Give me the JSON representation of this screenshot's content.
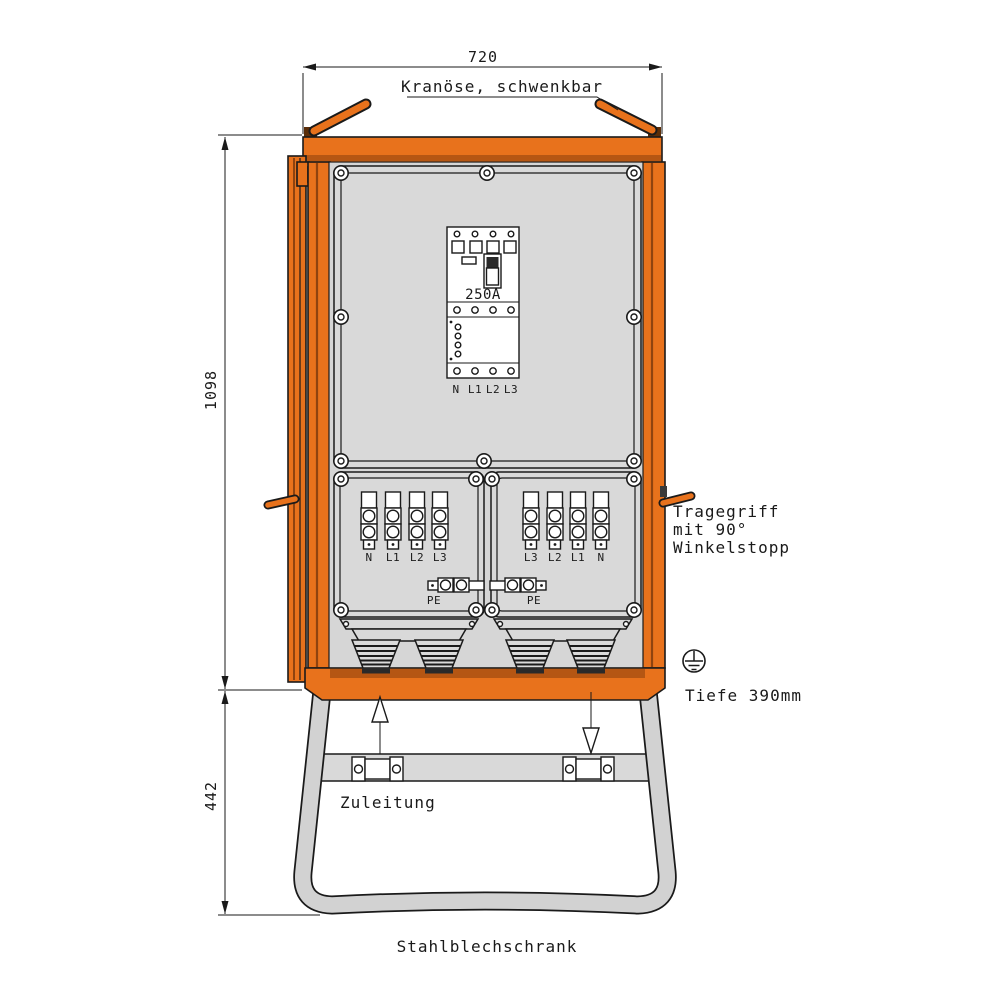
{
  "title": "Stahlblechschrank",
  "dims": {
    "width": "720",
    "body_height": "1098",
    "stand_height": "442"
  },
  "labels": {
    "crane": "Kranöse, schwenkbar",
    "carry1": "Tragegriff",
    "carry2": "mit 90°",
    "carry3": "Winkelstopp",
    "depth": "Tiefe 390mm",
    "supply": "Zuleitung"
  },
  "breaker": {
    "rating": "250A",
    "terminals": [
      "N",
      "L1",
      "L2",
      "L3"
    ]
  },
  "panel_left": {
    "terminals": [
      "N",
      "L1",
      "L2",
      "L3"
    ],
    "pe": "PE"
  },
  "panel_right": {
    "terminals": [
      "L3",
      "L2",
      "L1",
      "N"
    ],
    "pe": "PE"
  },
  "colors": {
    "cabinet_orange": "#E8721C",
    "edge_dark_orange": "#8F430F",
    "inner_lip_orange": "#B55613",
    "panel_gray": "#D9D9D9",
    "stand_gray": "#D2D2D2",
    "line": "#1a1a1a"
  }
}
